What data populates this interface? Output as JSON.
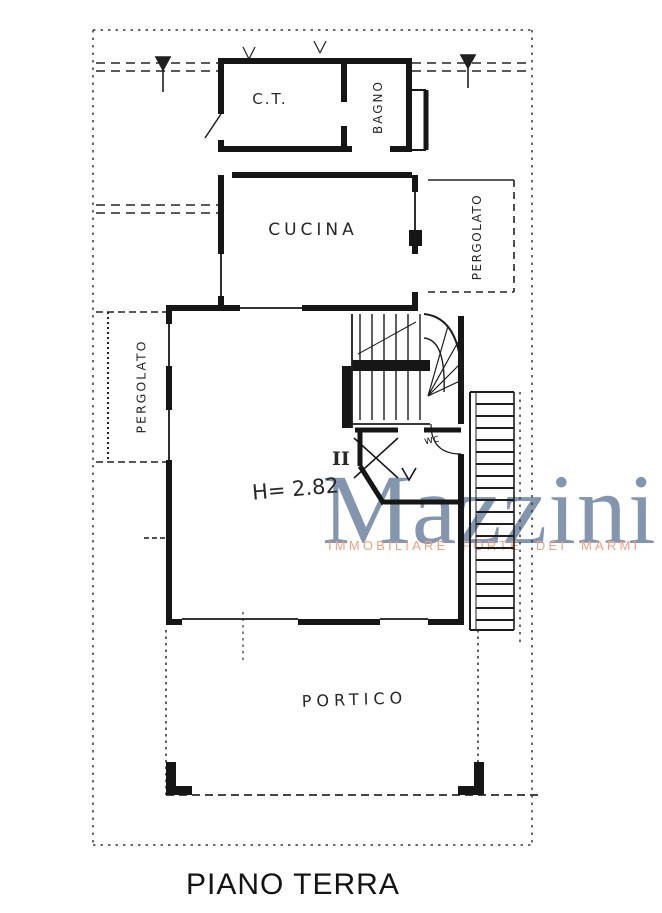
{
  "plan": {
    "title": "PIANO TERRA",
    "rooms": {
      "ct": "C.T.",
      "bagno": "BAGNO",
      "cucina": "CUCINA",
      "pergolato_left": "PERGOLATO",
      "pergolato_right": "PERGOLATO",
      "portico": "PORTICO",
      "wc": "wc",
      "unit": "II",
      "height": "H= 2.82"
    }
  },
  "watermark": {
    "name": "Mazzini",
    "subtitle": "IMMOBILIARE FORTE DEI MARMI",
    "name_color": "#8496ae",
    "subtitle_color": "#f0a183"
  },
  "colors": {
    "ink": "#1c1c1c",
    "paper": "#ffffff"
  }
}
